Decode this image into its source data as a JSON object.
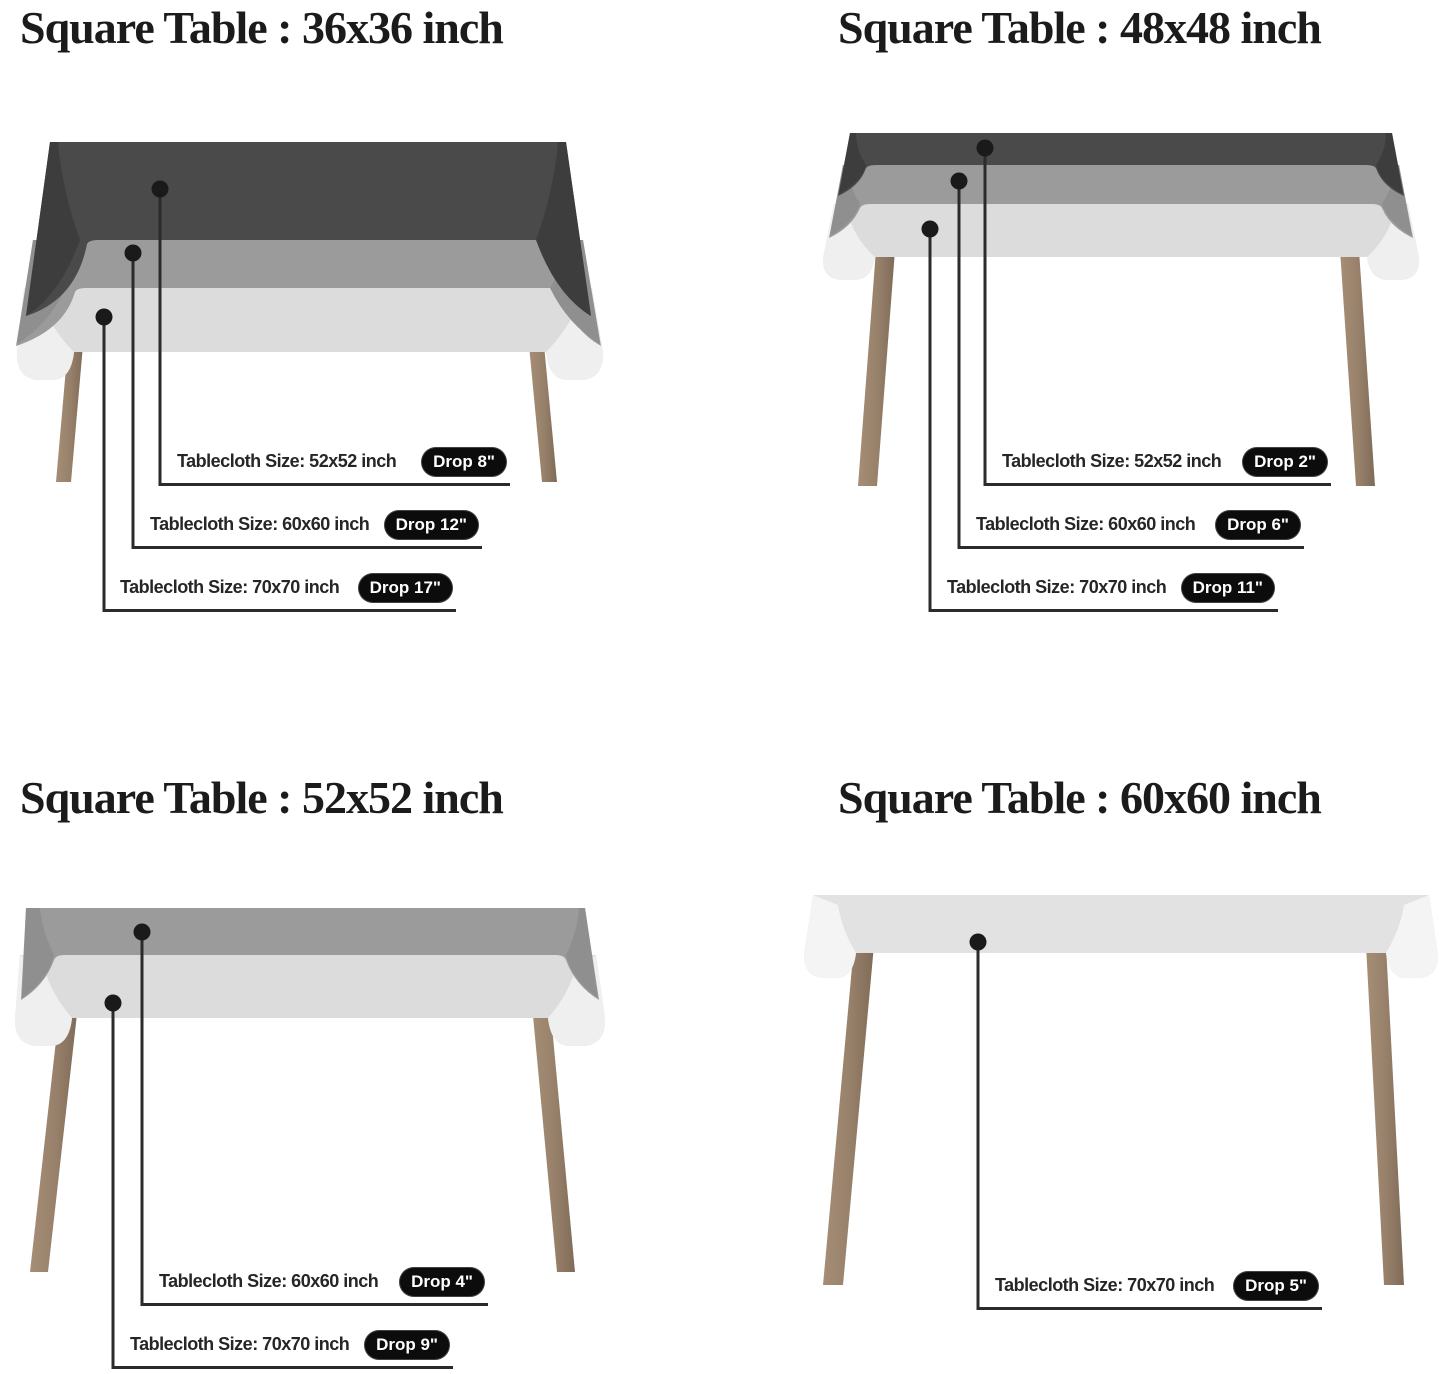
{
  "page": {
    "background": "#ffffff"
  },
  "colors": {
    "cloth_dark": "#4a4a4a",
    "cloth_dark_side": "#3d3d3d",
    "cloth_medium": "#9b9b9b",
    "cloth_medium_side": "#8f8f8f",
    "cloth_light": "#dcdcdc",
    "cloth_light_flap": "#efefef",
    "leg_brown": "#97806a",
    "callout_line": "#2b2b2b",
    "badge_bg": "#0c0c0c",
    "badge_text": "#ffffff",
    "heading_text": "#1b1b1b",
    "label_text": "#262626"
  },
  "panels": [
    {
      "id": "36x36",
      "title": "Square Table : 36x36 inch",
      "labels": [
        {
          "text": "Tablecloth Size: 52x52 inch",
          "drop": "Drop 8\""
        },
        {
          "text": "Tablecloth Size: 60x60 inch",
          "drop": "Drop 12\""
        },
        {
          "text": "Tablecloth Size: 70x70 inch",
          "drop": "Drop 17\""
        }
      ]
    },
    {
      "id": "48x48",
      "title": "Square Table : 48x48 inch",
      "labels": [
        {
          "text": "Tablecloth Size: 52x52 inch",
          "drop": "Drop 2\""
        },
        {
          "text": "Tablecloth Size: 60x60 inch",
          "drop": "Drop 6\""
        },
        {
          "text": "Tablecloth Size: 70x70 inch",
          "drop": "Drop 11\""
        }
      ]
    },
    {
      "id": "52x52",
      "title": "Square Table : 52x52 inch",
      "labels": [
        {
          "text": "Tablecloth Size: 60x60 inch",
          "drop": "Drop 4\""
        },
        {
          "text": "Tablecloth Size: 70x70 inch",
          "drop": "Drop 9\""
        }
      ]
    },
    {
      "id": "60x60",
      "title": "Square Table : 60x60 inch",
      "labels": [
        {
          "text": "Tablecloth Size: 70x70 inch",
          "drop": "Drop 5\""
        }
      ]
    }
  ]
}
